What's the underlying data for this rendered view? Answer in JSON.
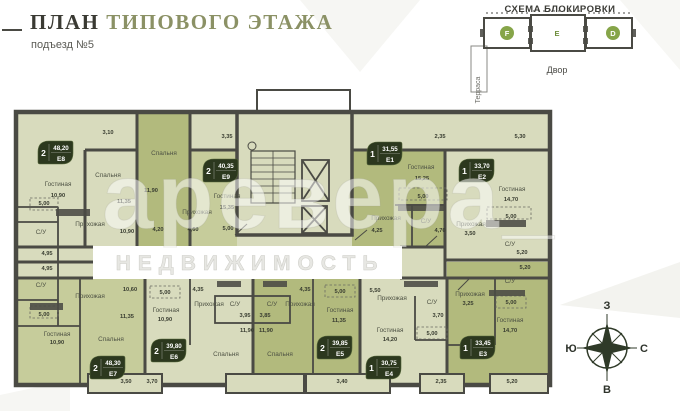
{
  "header": {
    "title_primary": "ПЛАН",
    "title_secondary": "ТИПОВОГО ЭТАЖА",
    "subtitle": "подъезд №5"
  },
  "block_scheme": {
    "title": "СХЕМА БЛОКИРОВКИ",
    "terrace_label": "Терраса",
    "yard_label": "Двор",
    "blocks": [
      {
        "label": "F"
      },
      {
        "label": "Е"
      },
      {
        "label": "D"
      }
    ],
    "active_block": "Е"
  },
  "watermark": {
    "brand": "аревера_",
    "line2": "НЕДВИЖИМОСТЬ"
  },
  "compass": {
    "top": "З",
    "left": "Ю",
    "right": "С",
    "bottom": "В"
  },
  "colors": {
    "accent_olive": "#8b9165",
    "unit_pale": "#d8dbbd",
    "unit_mid": "#c6cc9b",
    "unit_dark": "#b2ba7d",
    "wall": "#4a4a44",
    "badge_bg": "#2c381e",
    "scheme_green": "#93a351"
  },
  "plan": {
    "units": [
      {
        "rooms": "2",
        "area": "48,20",
        "id": "E8",
        "x": 38,
        "y": 141
      },
      {
        "rooms": "2",
        "area": "40,35",
        "id": "E9",
        "x": 203,
        "y": 159
      },
      {
        "rooms": "1",
        "area": "31,55",
        "id": "E1",
        "x": 367,
        "y": 142
      },
      {
        "rooms": "1",
        "area": "33,70",
        "id": "E2",
        "x": 459,
        "y": 159
      },
      {
        "rooms": "1",
        "area": "33,45",
        "id": "E3",
        "x": 460,
        "y": 336
      },
      {
        "rooms": "1",
        "area": "30,75",
        "id": "E4",
        "x": 366,
        "y": 356
      },
      {
        "rooms": "2",
        "area": "39,85",
        "id": "E5",
        "x": 317,
        "y": 336
      },
      {
        "rooms": "2",
        "area": "39,80",
        "id": "E6",
        "x": 151,
        "y": 339
      },
      {
        "rooms": "2",
        "area": "48,30",
        "id": "E7",
        "x": 90,
        "y": 356
      }
    ],
    "labels": [
      {
        "t": "Гостиная",
        "x": 58,
        "y": 186,
        "k": "room"
      },
      {
        "t": "10,90",
        "x": 58,
        "y": 197,
        "k": "dim"
      },
      {
        "t": "5,00",
        "x": 44,
        "y": 205,
        "k": "dim"
      },
      {
        "t": "С/У",
        "x": 41,
        "y": 234,
        "k": "room"
      },
      {
        "t": "4,95",
        "x": 47,
        "y": 255,
        "k": "dim"
      },
      {
        "t": "Прихожая",
        "x": 90,
        "y": 226,
        "k": "room"
      },
      {
        "t": "10,90",
        "x": 127,
        "y": 233,
        "k": "dim"
      },
      {
        "t": "3,10",
        "x": 108,
        "y": 134,
        "k": "dim"
      },
      {
        "t": "Спальня",
        "x": 108,
        "y": 177,
        "k": "room"
      },
      {
        "t": "11,35",
        "x": 124,
        "y": 203,
        "k": "dim"
      },
      {
        "t": "Спальня",
        "x": 164,
        "y": 155,
        "k": "room"
      },
      {
        "t": "11,90",
        "x": 151,
        "y": 192,
        "k": "dim"
      },
      {
        "t": "4,20",
        "x": 158,
        "y": 231,
        "k": "dim"
      },
      {
        "t": "3,35",
        "x": 227,
        "y": 138,
        "k": "dim"
      },
      {
        "t": "Гостиная",
        "x": 227,
        "y": 198,
        "k": "room"
      },
      {
        "t": "15,35",
        "x": 227,
        "y": 209,
        "k": "dim"
      },
      {
        "t": "Прихожая",
        "x": 197,
        "y": 214,
        "k": "room"
      },
      {
        "t": "4,60",
        "x": 193,
        "y": 231,
        "k": "dim"
      },
      {
        "t": "5,00",
        "x": 228,
        "y": 230,
        "k": "dim"
      },
      {
        "t": "2,35",
        "x": 440,
        "y": 138,
        "k": "dim"
      },
      {
        "t": "Гостиная",
        "x": 421,
        "y": 169,
        "k": "room"
      },
      {
        "t": "15,25",
        "x": 422,
        "y": 180,
        "k": "dim"
      },
      {
        "t": "5,00",
        "x": 423,
        "y": 198,
        "k": "dim"
      },
      {
        "t": "Прихожая",
        "x": 386,
        "y": 220,
        "k": "room"
      },
      {
        "t": "4,25",
        "x": 377,
        "y": 232,
        "k": "dim"
      },
      {
        "t": "С/У",
        "x": 426,
        "y": 223,
        "k": "room"
      },
      {
        "t": "4,70",
        "x": 440,
        "y": 232,
        "k": "dim"
      },
      {
        "t": "5,30",
        "x": 520,
        "y": 138,
        "k": "dim"
      },
      {
        "t": "Гостиная",
        "x": 512,
        "y": 191,
        "k": "room"
      },
      {
        "t": "14,70",
        "x": 511,
        "y": 201,
        "k": "dim"
      },
      {
        "t": "5,00",
        "x": 511,
        "y": 218,
        "k": "dim"
      },
      {
        "t": "Прихожая",
        "x": 471,
        "y": 226,
        "k": "room"
      },
      {
        "t": "3,50",
        "x": 470,
        "y": 235,
        "k": "dim"
      },
      {
        "t": "С/У",
        "x": 510,
        "y": 246,
        "k": "room"
      },
      {
        "t": "5,20",
        "x": 522,
        "y": 254,
        "k": "dim"
      },
      {
        "t": "5,20",
        "x": 525,
        "y": 269,
        "k": "dim"
      },
      {
        "t": "С/У",
        "x": 510,
        "y": 283,
        "k": "room"
      },
      {
        "t": "Прихожая",
        "x": 470,
        "y": 296,
        "k": "room"
      },
      {
        "t": "3,25",
        "x": 468,
        "y": 305,
        "k": "dim"
      },
      {
        "t": "5,00",
        "x": 511,
        "y": 304,
        "k": "dim"
      },
      {
        "t": "Гостиная",
        "x": 510,
        "y": 322,
        "k": "room"
      },
      {
        "t": "14,70",
        "x": 510,
        "y": 332,
        "k": "dim"
      },
      {
        "t": "5,50",
        "x": 375,
        "y": 292,
        "k": "dim"
      },
      {
        "t": "Прихожая",
        "x": 392,
        "y": 300,
        "k": "room"
      },
      {
        "t": "С/У",
        "x": 432,
        "y": 304,
        "k": "room"
      },
      {
        "t": "3,70",
        "x": 438,
        "y": 317,
        "k": "dim"
      },
      {
        "t": "5,00",
        "x": 432,
        "y": 335,
        "k": "dim"
      },
      {
        "t": "Гостиная",
        "x": 390,
        "y": 332,
        "k": "room"
      },
      {
        "t": "14,20",
        "x": 390,
        "y": 341,
        "k": "dim"
      },
      {
        "t": "4,35",
        "x": 305,
        "y": 291,
        "k": "dim"
      },
      {
        "t": "Прихожая",
        "x": 300,
        "y": 306,
        "k": "room"
      },
      {
        "t": "С/У",
        "x": 272,
        "y": 306,
        "k": "room"
      },
      {
        "t": "3,85",
        "x": 265,
        "y": 317,
        "k": "dim"
      },
      {
        "t": "11,90",
        "x": 266,
        "y": 332,
        "k": "dim"
      },
      {
        "t": "Спальня",
        "x": 280,
        "y": 356,
        "k": "room"
      },
      {
        "t": "Гостиная",
        "x": 340,
        "y": 312,
        "k": "room"
      },
      {
        "t": "11,35",
        "x": 339,
        "y": 322,
        "k": "dim"
      },
      {
        "t": "5,00",
        "x": 340,
        "y": 293,
        "k": "dim"
      },
      {
        "t": "4,35",
        "x": 198,
        "y": 291,
        "k": "dim"
      },
      {
        "t": "Прихожая",
        "x": 209,
        "y": 306,
        "k": "room"
      },
      {
        "t": "С/У",
        "x": 235,
        "y": 306,
        "k": "room"
      },
      {
        "t": "3,95",
        "x": 245,
        "y": 317,
        "k": "dim"
      },
      {
        "t": "11,90",
        "x": 247,
        "y": 332,
        "k": "dim"
      },
      {
        "t": "Спальня",
        "x": 226,
        "y": 356,
        "k": "room"
      },
      {
        "t": "Гостиная",
        "x": 166,
        "y": 312,
        "k": "room"
      },
      {
        "t": "10,90",
        "x": 165,
        "y": 321,
        "k": "dim"
      },
      {
        "t": "5,00",
        "x": 165,
        "y": 294,
        "k": "dim"
      },
      {
        "t": "С/У",
        "x": 41,
        "y": 287,
        "k": "room"
      },
      {
        "t": "4,95",
        "x": 47,
        "y": 270,
        "k": "dim"
      },
      {
        "t": "10,60",
        "x": 130,
        "y": 291,
        "k": "dim"
      },
      {
        "t": "Прихожая",
        "x": 90,
        "y": 298,
        "k": "room"
      },
      {
        "t": "11,35",
        "x": 127,
        "y": 318,
        "k": "dim"
      },
      {
        "t": "5,00",
        "x": 44,
        "y": 316,
        "k": "dim"
      },
      {
        "t": "Гостиная",
        "x": 57,
        "y": 336,
        "k": "room"
      },
      {
        "t": "10,90",
        "x": 57,
        "y": 344,
        "k": "dim"
      },
      {
        "t": "Спальня",
        "x": 111,
        "y": 341,
        "k": "room"
      },
      {
        "t": "3,50",
        "x": 126,
        "y": 383,
        "k": "dim"
      },
      {
        "t": "3,70",
        "x": 152,
        "y": 383,
        "k": "dim"
      },
      {
        "t": "3,40",
        "x": 342,
        "y": 383,
        "k": "dim"
      },
      {
        "t": "2,35",
        "x": 441,
        "y": 383,
        "k": "dim"
      },
      {
        "t": "5,20",
        "x": 512,
        "y": 383,
        "k": "dim"
      }
    ]
  }
}
